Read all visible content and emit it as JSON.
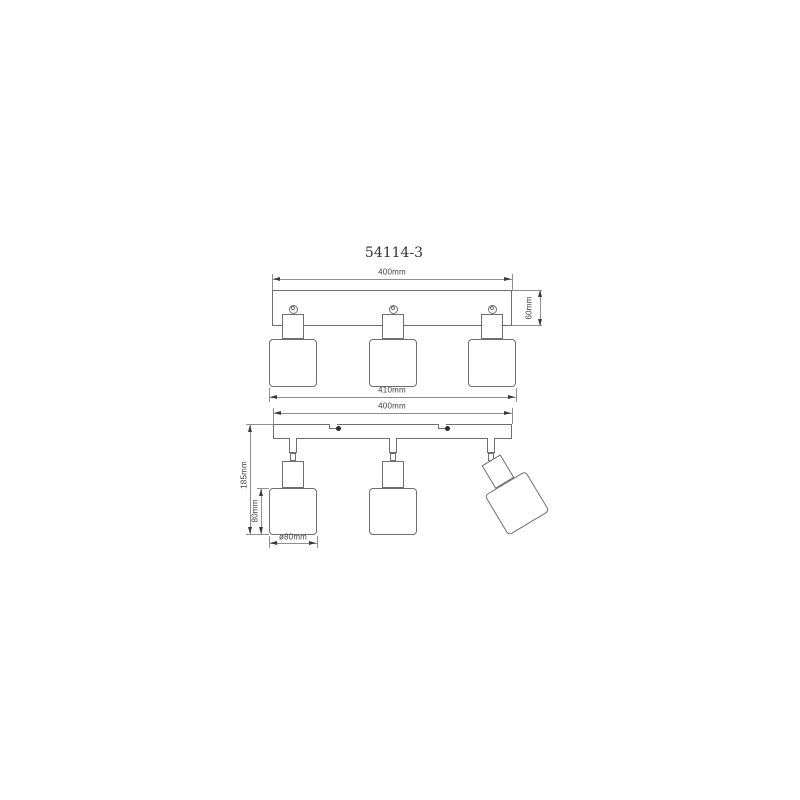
{
  "drawing": {
    "title": "54114-3",
    "type": "technical-dimension-drawing",
    "lamp_count": 3,
    "colors": {
      "background": "#ffffff",
      "object_line": "#6f6f6f",
      "dimension_line": "#8f8f8f",
      "text": "#3f3f3f",
      "screw_dot": "#2a2a2a"
    },
    "top_view": {
      "dim_width": "400mm",
      "dim_height": "60mm",
      "dim_overall": "410mm"
    },
    "bottom_view": {
      "dim_width": "400mm",
      "dim_total_height": "185mm",
      "dim_shade_height": "80mm",
      "dim_shade_diameter": "ø80mm"
    }
  }
}
